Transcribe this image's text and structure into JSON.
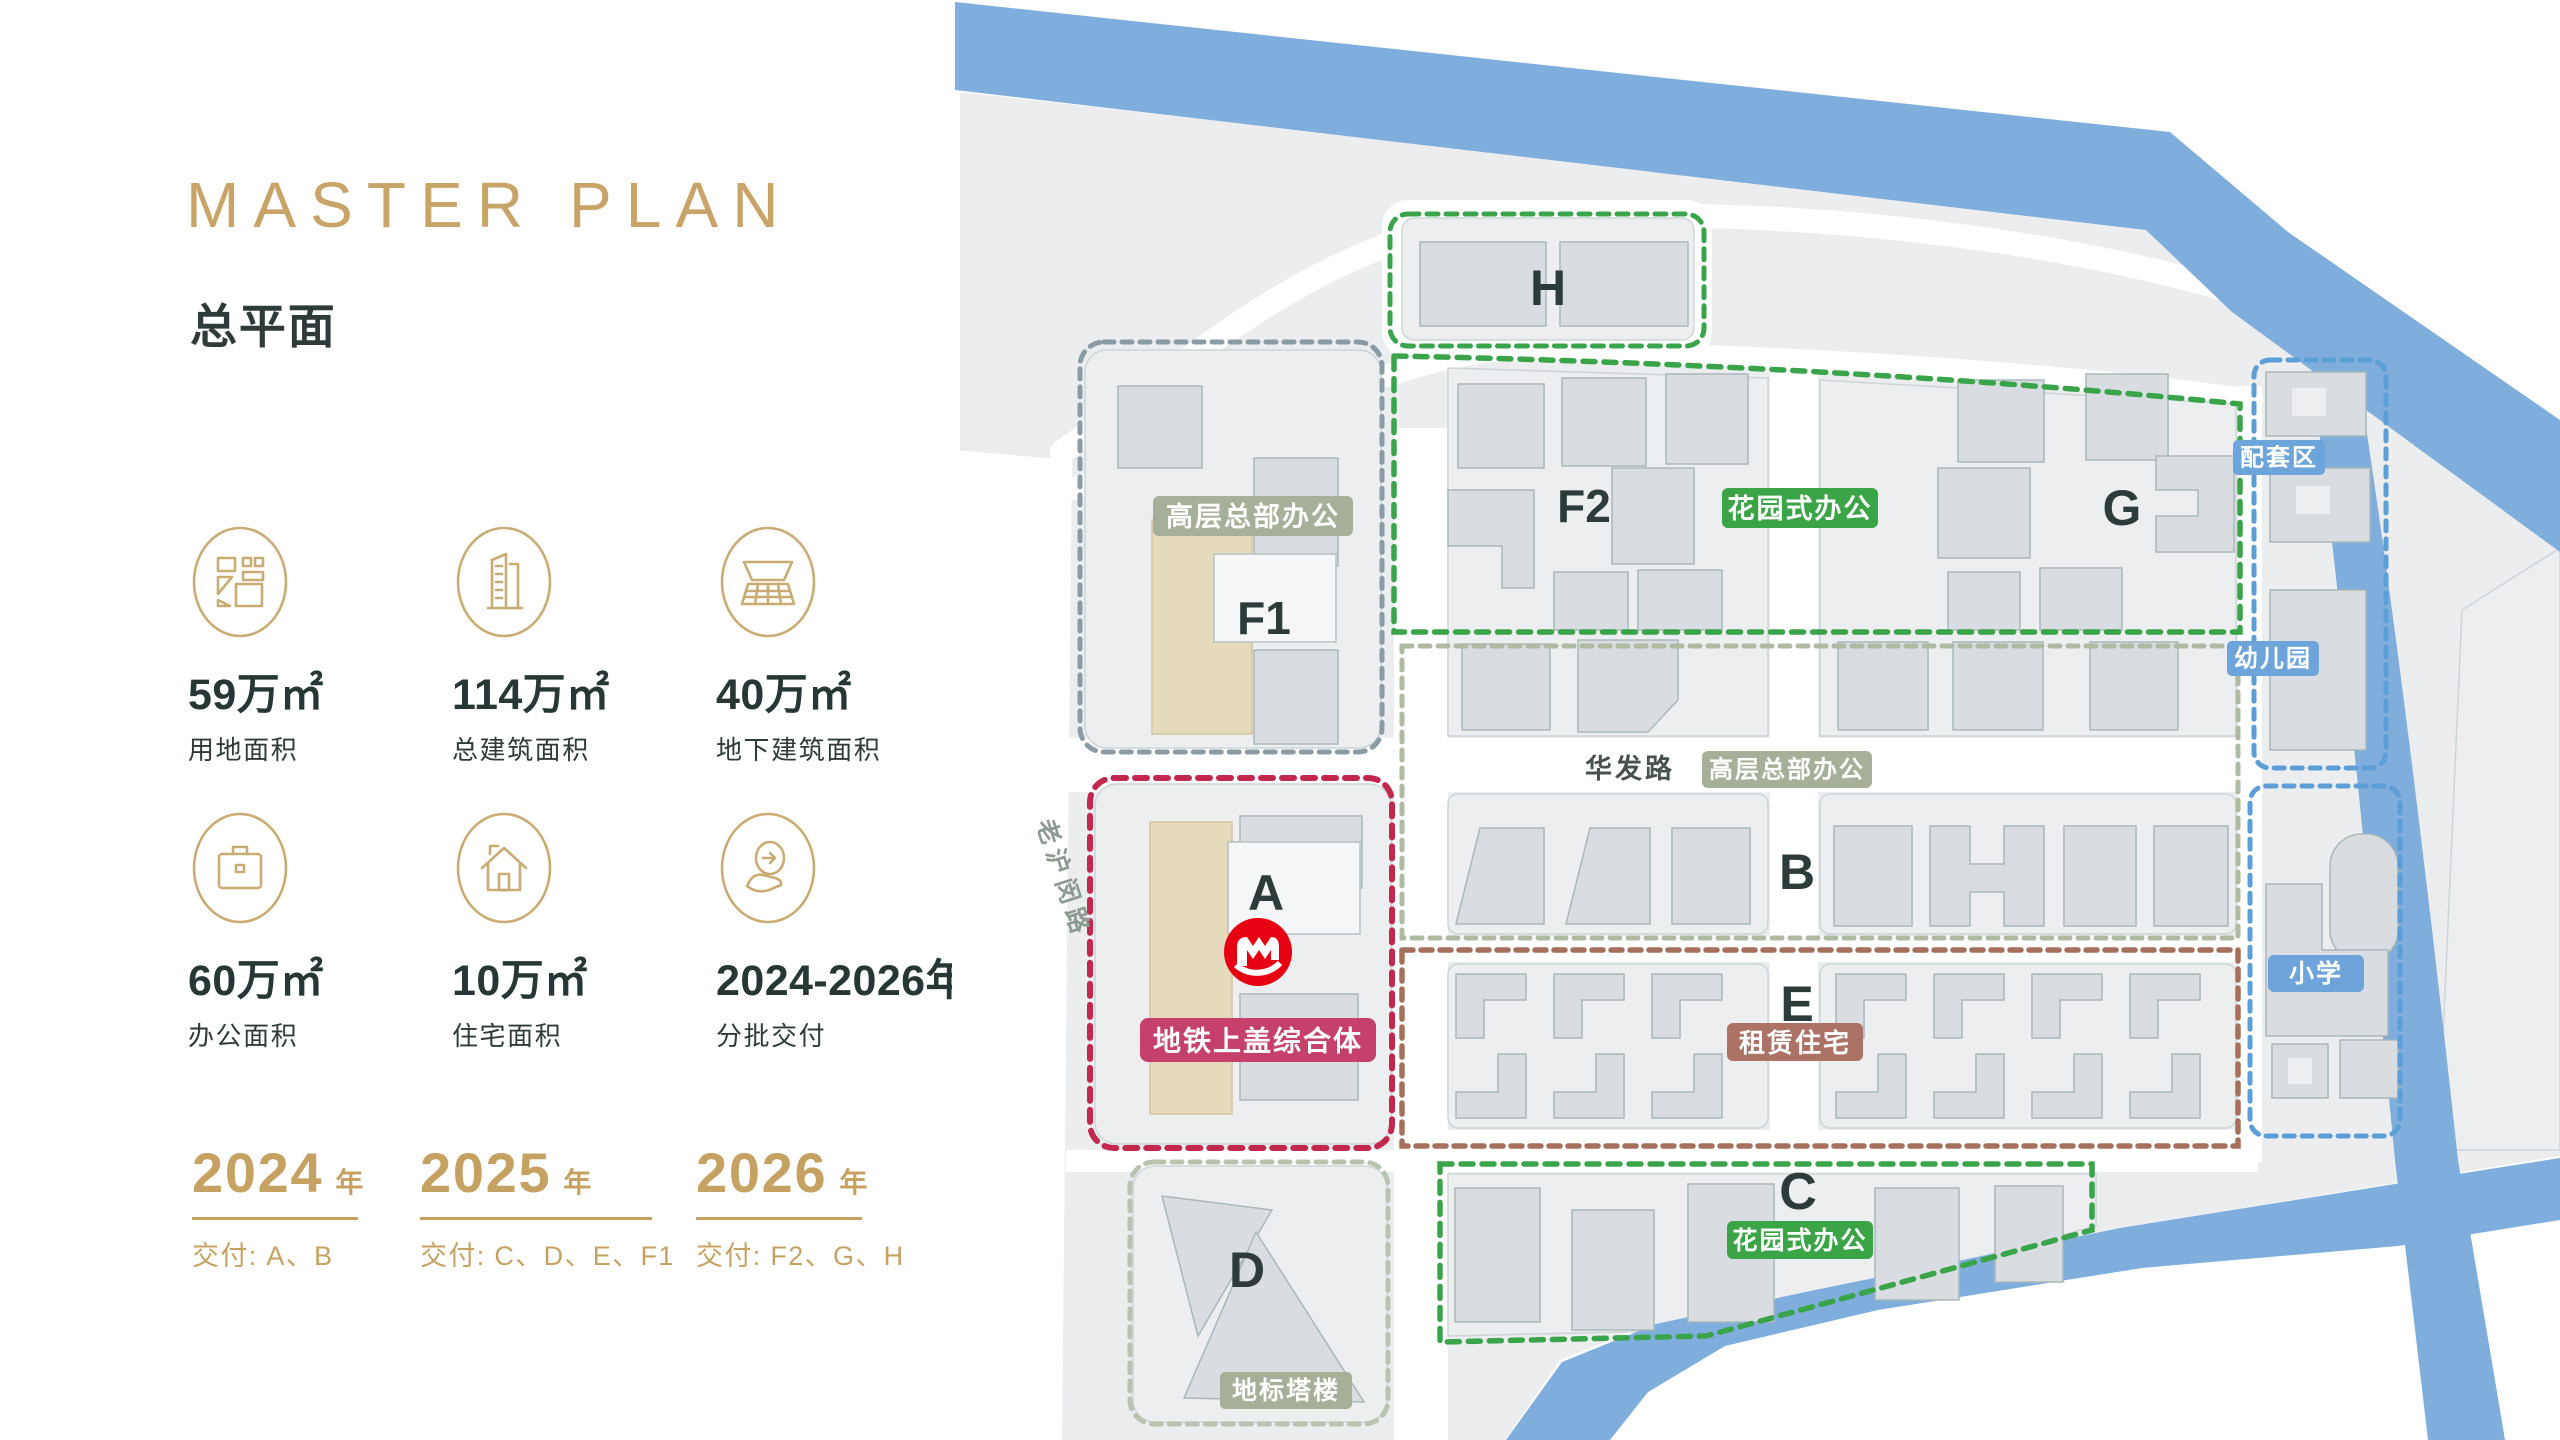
{
  "title": {
    "en": "MASTER PLAN",
    "zh": "总平面"
  },
  "stats": [
    {
      "value": "59万㎡",
      "label": "用地面积",
      "icon": "land-parcel-icon"
    },
    {
      "value": "114万㎡",
      "label": "总建筑面积",
      "icon": "building-area-icon"
    },
    {
      "value": "40万㎡",
      "label": "地下建筑面积",
      "icon": "underground-area-icon"
    },
    {
      "value": "60万㎡",
      "label": "办公面积",
      "icon": "office-briefcase-icon"
    },
    {
      "value": "10万㎡",
      "label": "住宅面积",
      "icon": "house-icon"
    },
    {
      "value": "2024-2026年",
      "label": "分批交付",
      "icon": "delivery-handover-icon"
    }
  ],
  "phases": [
    {
      "year": "2024",
      "year_suffix": "年",
      "deliver": "交付: A、B"
    },
    {
      "year": "2025",
      "year_suffix": "年",
      "deliver": "交付: C、D、E、F1"
    },
    {
      "year": "2026",
      "year_suffix": "年",
      "deliver": "交付: F2、G、H"
    }
  ],
  "map": {
    "labels": {
      "h": "H",
      "f1": "F1",
      "f2": "F2",
      "g": "G",
      "a": "A",
      "b": "B",
      "e": "E",
      "c": "C",
      "d": "D"
    },
    "badges": {
      "hq_f1": "高层总部办公",
      "hq_road": "高层总部办公",
      "garden_top": "花园式办公",
      "garden_c": "花园式办公",
      "metro_complex": "地铁上盖综合体",
      "rental": "租赁住宅",
      "support": "配套区",
      "kindergarten": "幼儿园",
      "primary_school": "小学",
      "landmark": "地标塔楼"
    },
    "roads": {
      "huafa": "华发路",
      "laohumin": "老沪闵路"
    }
  },
  "colors": {
    "gold": "#C9A469",
    "dark": "#2F3B3A",
    "zone_green": "#3AA44B",
    "zone_sage": "#A6B098",
    "zone_crimson": "#C2284E",
    "zone_brown": "#A5705C",
    "zone_blue": "#6DA5DA",
    "river": "#7FAEDC",
    "metro_red": "#E60012",
    "land": "#EBEDEF",
    "building": "#D9DDE1",
    "tan_building": "#E6DABD"
  }
}
